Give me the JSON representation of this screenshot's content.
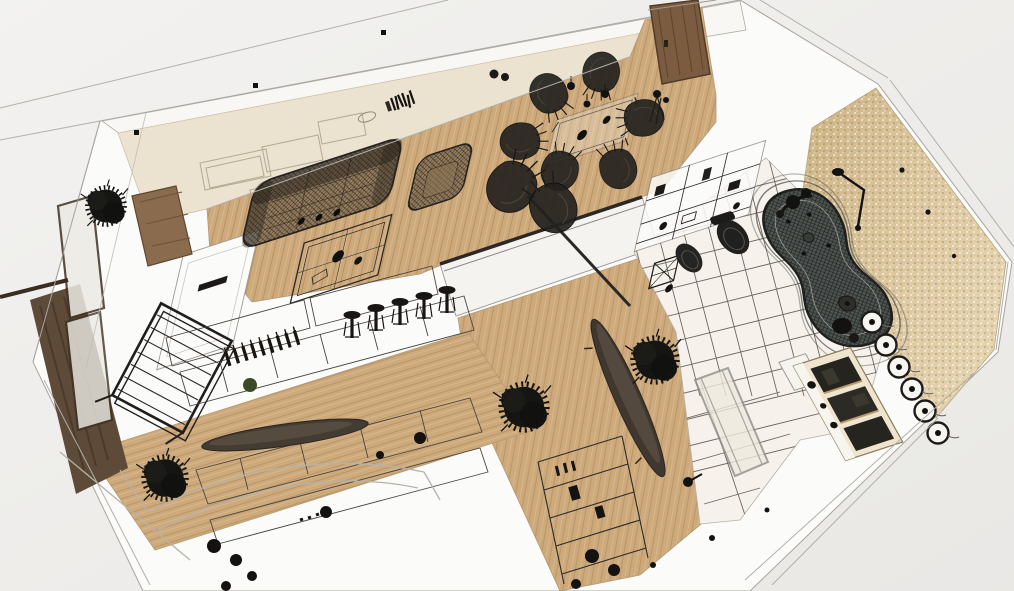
{
  "scene": {
    "type": "axonometric-3d-floor-plan-render",
    "style": "wireframe-sketch-with-textured-floors",
    "visible_text": "none",
    "palette": {
      "background": "#f1f0ee",
      "background_deep": "#e7e6e4",
      "slab_white": "#fbfbfa",
      "line_gray": "#a9a49c",
      "wall_cream": "#ebe2cf",
      "wall_band": "#f8f7f4",
      "wood_base": "#cda97c",
      "wood_stripe": "#a3834f",
      "wood_light": "#e4cda4",
      "tile_floor": "#f6f2eb",
      "grout": "#55504a",
      "mosaic": "#d9c39a",
      "mosaic_deep": "#c5ab7c",
      "wire_dark": "#23211e",
      "tub_gray": "#4d5451",
      "door_wood": "#7b5c41",
      "deck_dark": "#5d4a38",
      "void_white": "#f4f3f0",
      "sofa_tint": "#6b5a45"
    },
    "rooms": [
      {
        "name": "living-room",
        "items": [
          "wireframe-sofa",
          "wireframe-armchair",
          "wireframe-coffee-table",
          "media-console-outlines",
          "books",
          "fireplace-column",
          "media-wall-panel",
          "plant"
        ]
      },
      {
        "name": "dining-area",
        "items": [
          "glass-dining-table",
          "mesh-shell-chairs",
          "pendant-lamp-dots"
        ]
      },
      {
        "name": "entry",
        "items": [
          "wood-entry-door",
          "coat-stand"
        ]
      },
      {
        "name": "bathroom",
        "items": [
          "freeform-wireframe-bathtub",
          "toilet",
          "bidet",
          "shower-fixture",
          "vanity-cabinet",
          "wall-sconces",
          "mosaic-wall",
          "white-floor-tiles",
          "glass-pivot-door",
          "wire-basket-table"
        ]
      },
      {
        "name": "hallway",
        "items": [
          "oval-console-table",
          "plants",
          "under-slab-shelf-rack"
        ]
      },
      {
        "name": "kitchen",
        "items": [
          "counter-wireframes",
          "bar-stools",
          "wine-bottles",
          "oval-countertop",
          "plant",
          "appliance-blobs"
        ]
      },
      {
        "name": "window-side",
        "items": [
          "window-frames",
          "balcony-deck",
          "wireframe-lounge-chair"
        ]
      }
    ],
    "counts": {
      "mesh_chairs": 8,
      "bar_stools": 5,
      "wall_sconces": 6,
      "wine_bottles": 9,
      "ceiling_dots": 3
    }
  }
}
